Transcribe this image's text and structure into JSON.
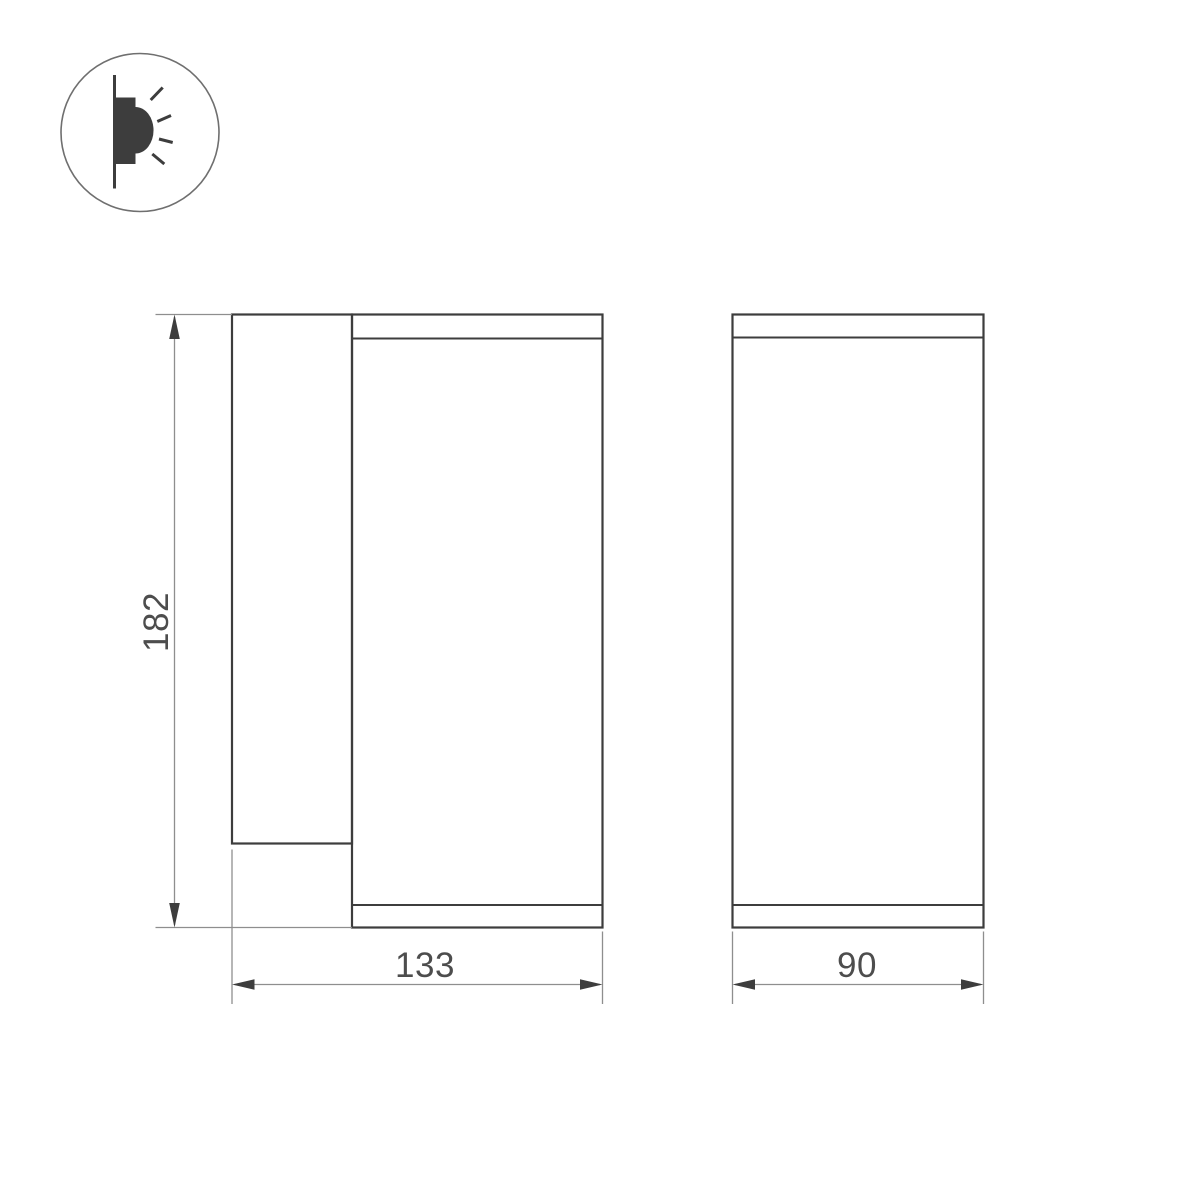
{
  "colors": {
    "background": "#ffffff",
    "outline": "#3d3d3d",
    "dim_line": "#8e8e8e",
    "arrow": "#3d3d3d",
    "label": "#4d4d4d",
    "icon_stroke": "#6f6f6f"
  },
  "icon": {
    "name": "wall-light-side-emission-icon"
  },
  "dimensions": {
    "height_mm": "182",
    "width_mm": "133",
    "depth_mm": "90"
  }
}
